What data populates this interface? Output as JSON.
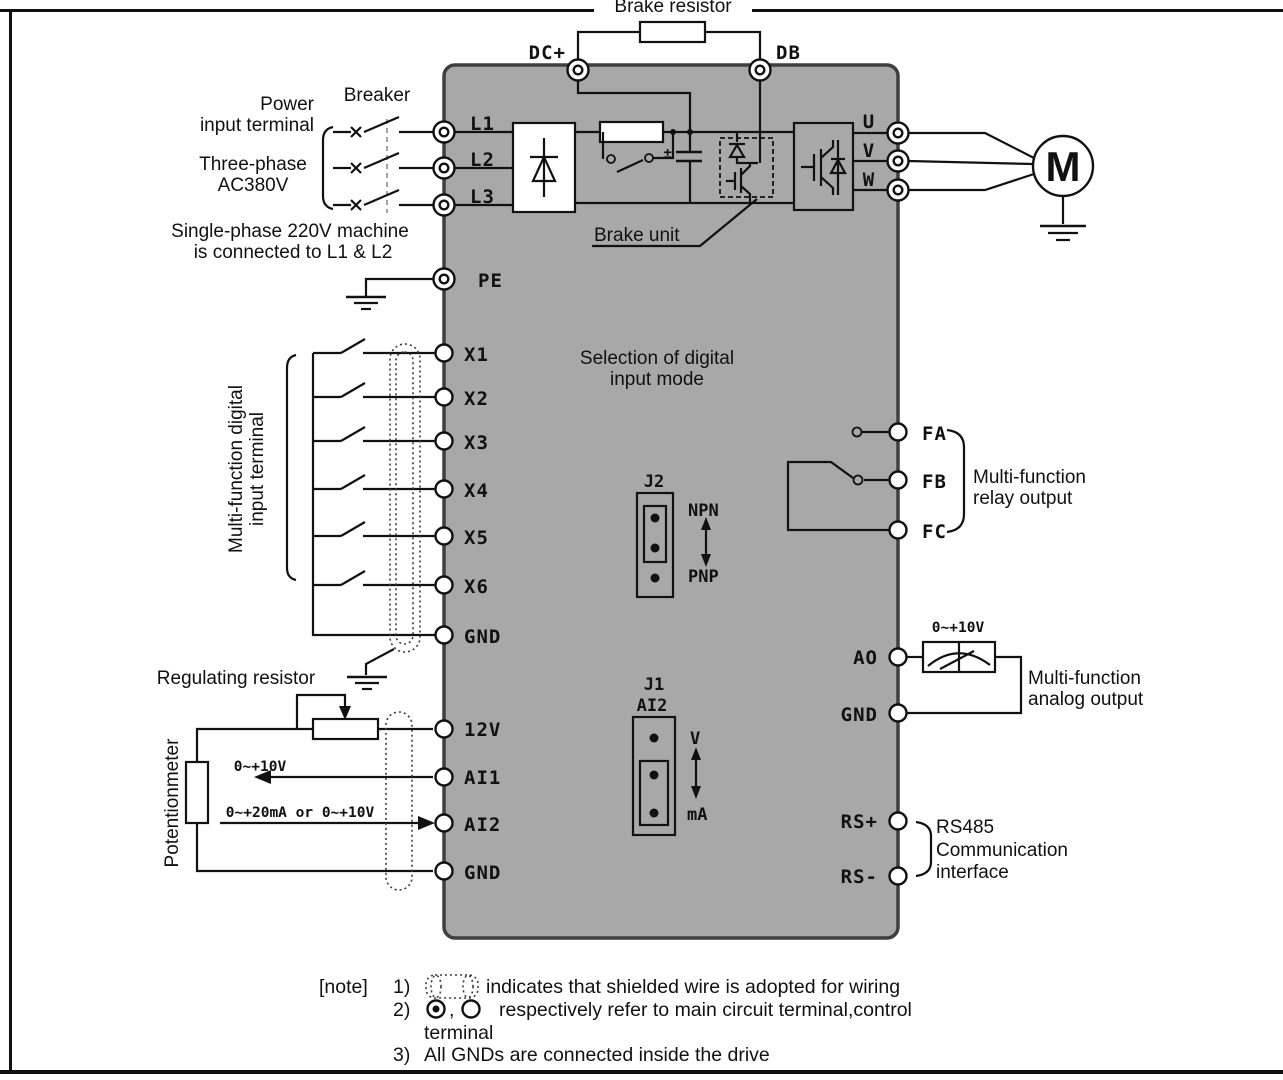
{
  "colors": {
    "drive_fill": "#a8a8a8",
    "drive_stroke": "#3f3f3f",
    "line": "#111111"
  },
  "labels": {
    "brake_resistor": "Brake resistor",
    "power_line1": "Power",
    "power_line2": "input terminal",
    "breaker": "Breaker",
    "phase_line1": "Three-phase",
    "phase_line2": "AC380V",
    "single_line1": "Single-phase 220V machine",
    "single_line2": "is connected to L1 & L2",
    "brake_unit": "Brake unit",
    "motor": "M",
    "mode_line1": "Selection of digital",
    "mode_line2": "input mode",
    "digital_group_line1": "Multi-function digital",
    "digital_group_line2": "input terminal",
    "regulating_resistor": "Regulating resistor",
    "potentiometer": "Potentionmeter",
    "ai1_range": "0~+10V",
    "ai2_range": "0~+20mA or 0~+10V",
    "ao_range": "0~+10V",
    "relay_line1": "Multi-function",
    "relay_line2": "relay output",
    "analog_line1": "Multi-function",
    "analog_line2": "analog output",
    "rs485_line1": "RS485",
    "rs485_line2": "Communication",
    "rs485_line3": "interface"
  },
  "jumpers": {
    "j2": {
      "name": "J2",
      "top": "NPN",
      "bottom": "PNP"
    },
    "j1": {
      "name": "J1",
      "sub": "AI2",
      "top": "V",
      "bottom": "mA"
    }
  },
  "terminals": {
    "dc": [
      "DC+",
      "DB"
    ],
    "power_input": [
      "L1",
      "L2",
      "L3"
    ],
    "pe": "PE",
    "output": [
      "U",
      "V",
      "W"
    ],
    "digital": [
      "X1",
      "X2",
      "X3",
      "X4",
      "X5",
      "X6"
    ],
    "digital_gnd": "GND",
    "analog": [
      "12V",
      "AI1",
      "AI2",
      "GND"
    ],
    "relay": [
      "FA",
      "FB",
      "FC"
    ],
    "analog_out": [
      "AO",
      "GND"
    ],
    "comm": [
      "RS+",
      "RS-"
    ]
  },
  "notes": {
    "tag": "[note]",
    "item1_num": "1)",
    "item1_text": "indicates that shielded wire is adopted for wiring",
    "item2_num": "2)",
    "item2_sep": ",",
    "item2_text": "respectively refer to main circuit terminal,control",
    "item2_text2": "terminal",
    "item3_num": "3)",
    "item3_text": "All GNDs are connected inside the drive"
  }
}
